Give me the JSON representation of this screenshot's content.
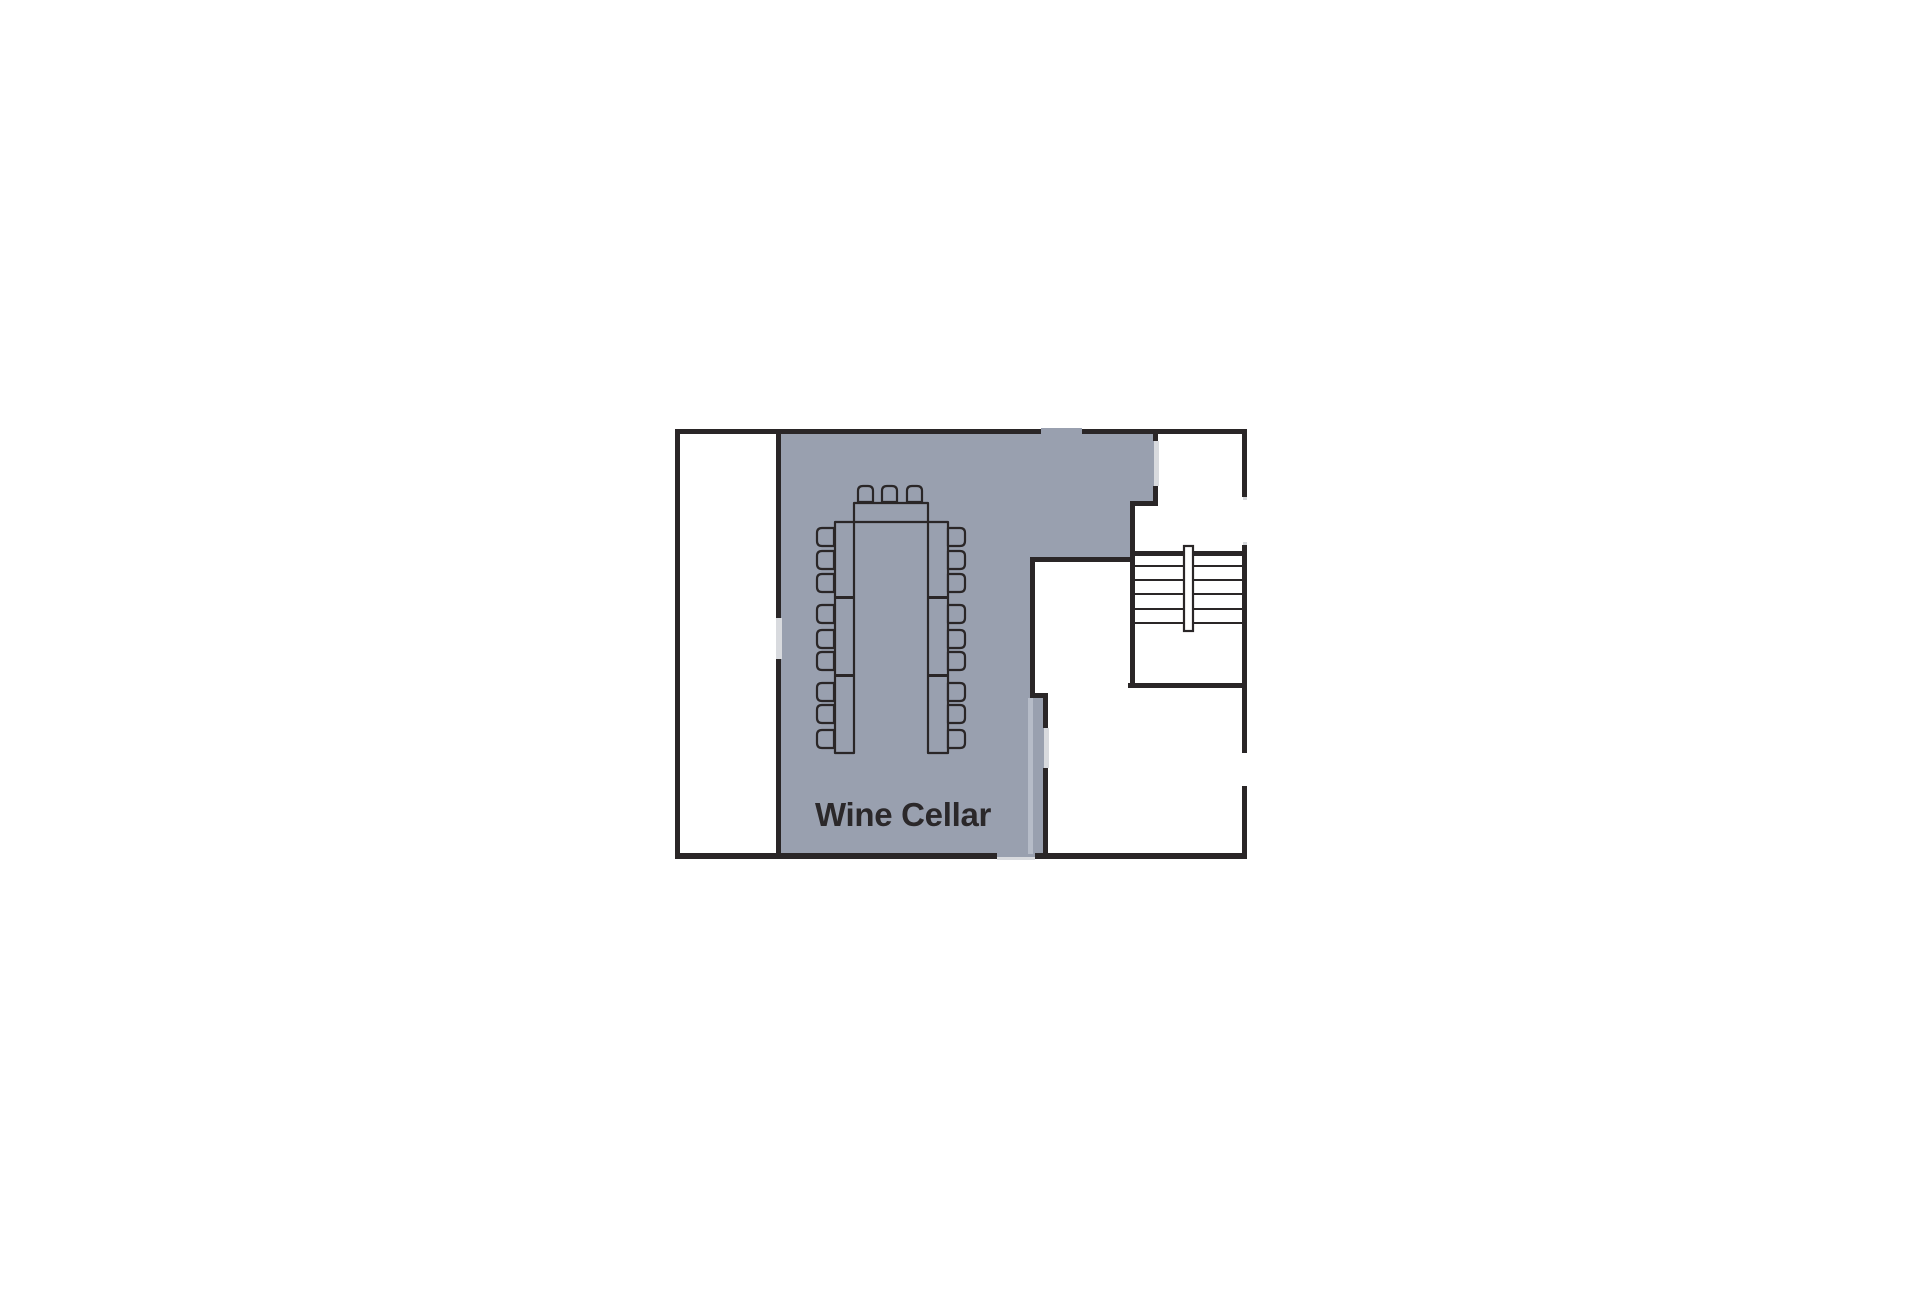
{
  "floor_plan": {
    "room_label": "Wine Cellar",
    "highlighted_room": "Wine Cellar",
    "seat_count": 21,
    "table_sections": 7,
    "stair_treads": 6
  },
  "colors": {
    "bg": "#ffffff",
    "wall": "#2a2627",
    "room": "#99a0af",
    "door": "#d8dade",
    "ghost": "#b6bcc8",
    "text": "#2b282a"
  }
}
